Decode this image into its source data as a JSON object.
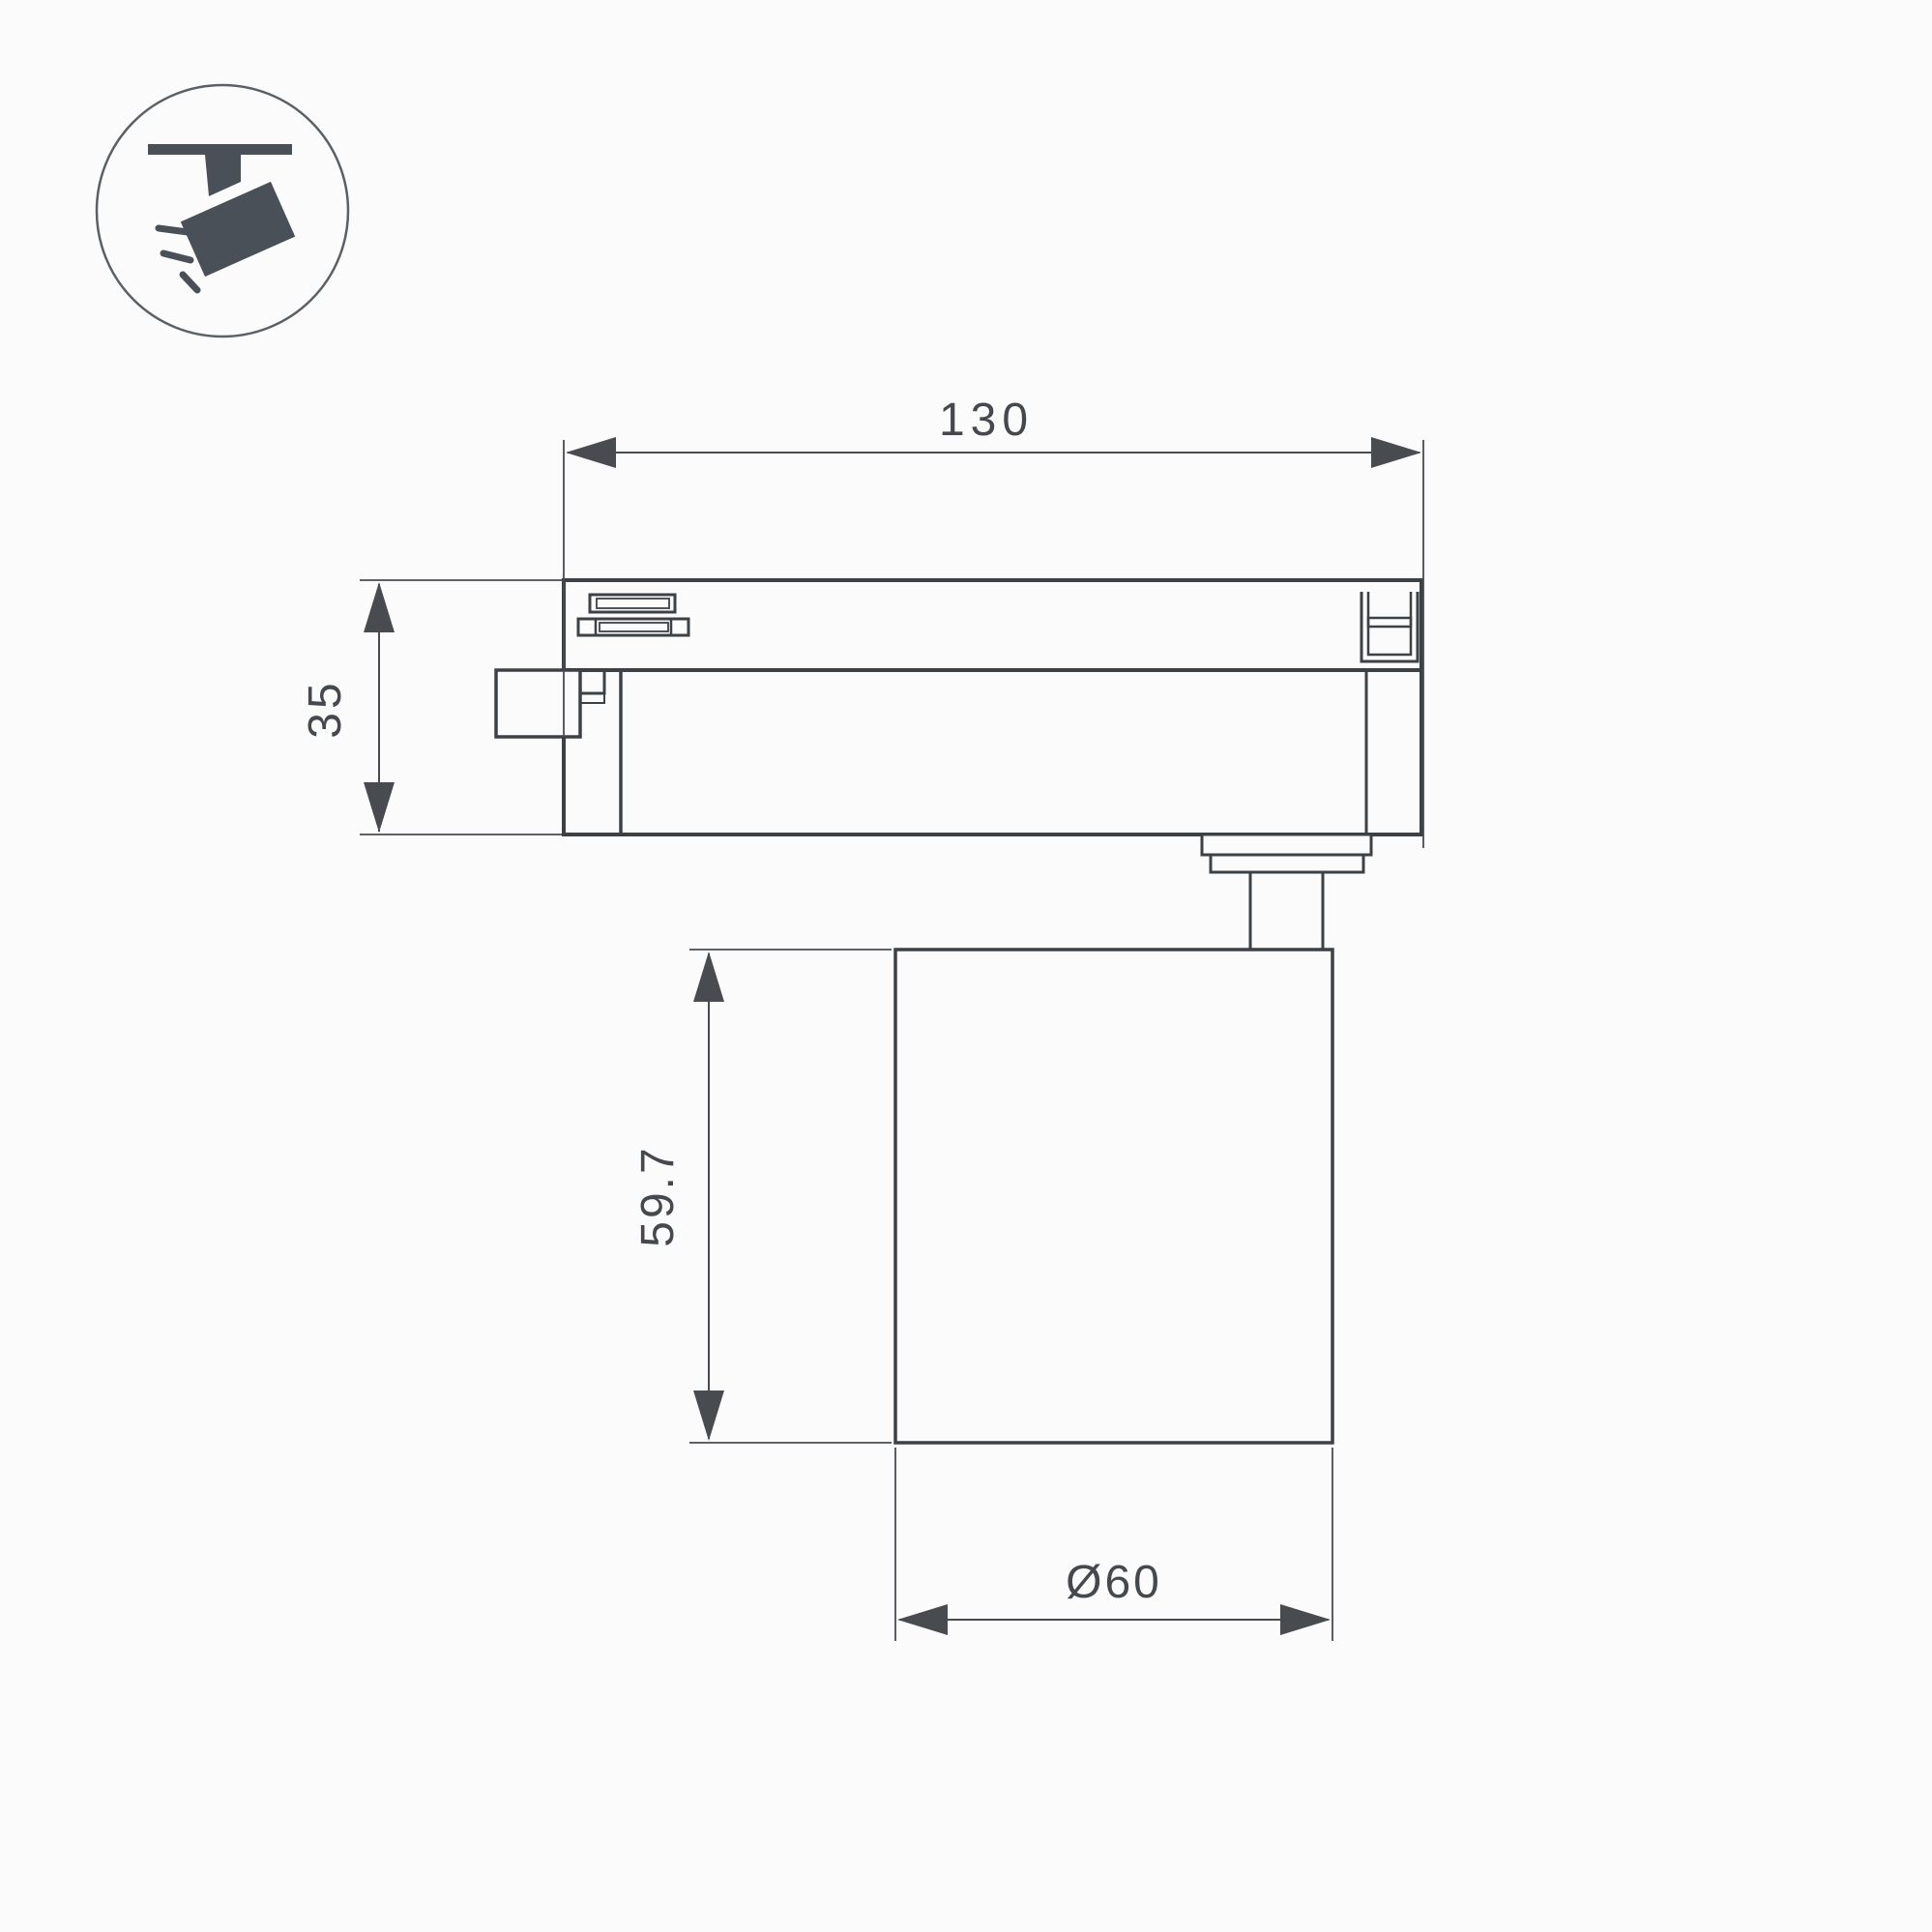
{
  "title": "track-spotlight-dimension-drawing",
  "colors": {
    "background": "#fbfbfb",
    "line": "#3c4146",
    "dim": "#484c51",
    "text": "#45494e",
    "icon": "#4a5057",
    "icon_ring": "#5a6065"
  },
  "icon": {
    "name": "track-spotlight"
  },
  "dimensions": {
    "width": {
      "label": "130"
    },
    "adapter_height": {
      "label": "35"
    },
    "body_height": {
      "label": "59.7"
    },
    "diameter": {
      "label": "Ø60"
    }
  }
}
